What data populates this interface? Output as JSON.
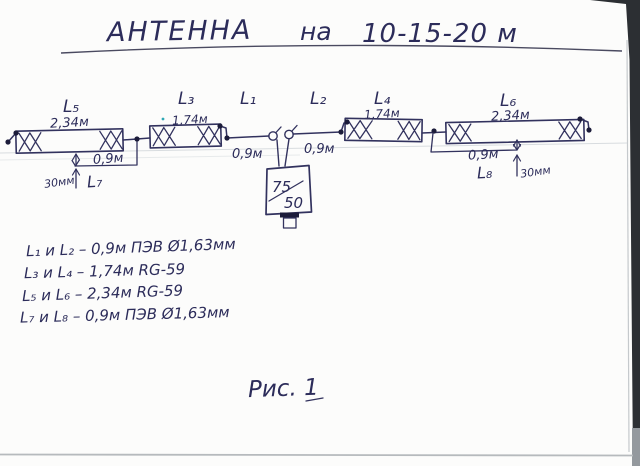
{
  "title": {
    "part1": "АНТЕННА",
    "part2": "на",
    "part3": "10-15-20 м"
  },
  "elements": {
    "l5": {
      "name": "L₅",
      "length": "2,34м"
    },
    "l3": {
      "name": "L₃",
      "length": "1,74м"
    },
    "l1": {
      "name": "L₁",
      "length": "0,9м"
    },
    "l2": {
      "name": "L₂",
      "length": "0,9м"
    },
    "l4": {
      "name": "L₄",
      "length": "1,74м"
    },
    "l6": {
      "name": "L₆",
      "length": "2,34м"
    }
  },
  "stubs": {
    "l7": {
      "name": "L₇",
      "length": "0,9м",
      "offset": "30мм"
    },
    "l8": {
      "name": "L₈",
      "length": "0,9м",
      "offset": "30мм"
    }
  },
  "balun": {
    "numerator": "75",
    "denominator": "50"
  },
  "legend": {
    "rows": [
      {
        "text": "L₁ и L₂ – 0,9м ПЭВ Ø1,63мм"
      },
      {
        "text": "L₃ и L₄ – 1,74м RG-59"
      },
      {
        "text": "L₅ и L₆ – 2,34м RG-59"
      },
      {
        "text": "L₇ и L₈ – 0,9м ПЭВ Ø1,63мм"
      }
    ]
  },
  "figure": {
    "caption": "Рис. 1"
  },
  "ink_color": "#32325e"
}
